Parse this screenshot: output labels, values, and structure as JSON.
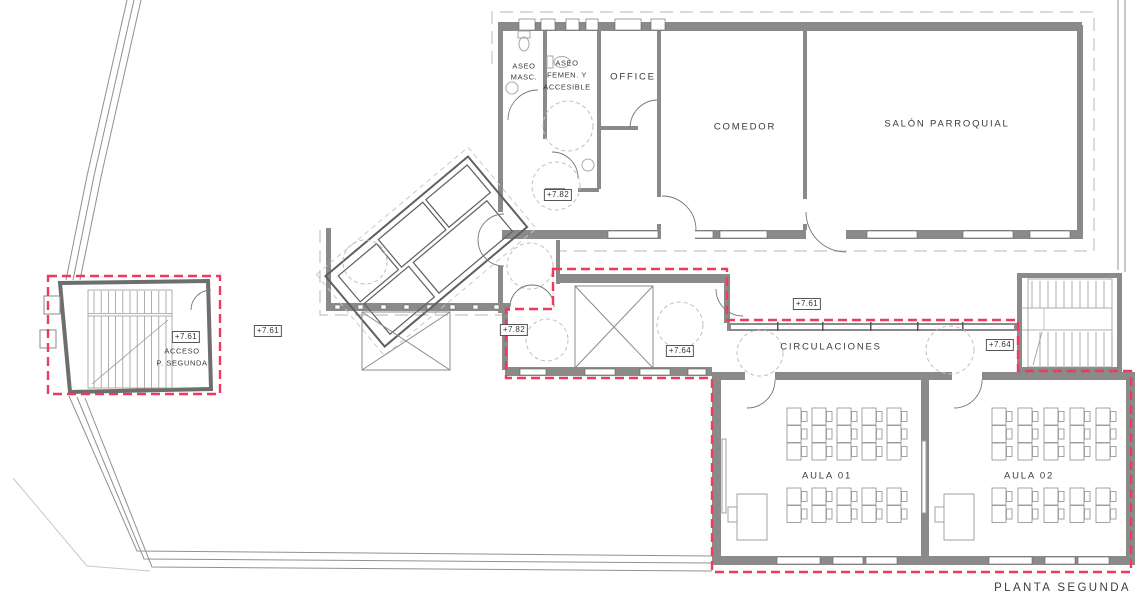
{
  "title": "PLANTA SEGUNDA",
  "rooms": {
    "aseo_masc": {
      "line1": "ASEO",
      "line2": "MASC."
    },
    "aseo_femen": {
      "line1": "ASEO",
      "line2": "FEMEN. Y",
      "line3": "ACCESIBLE"
    },
    "office": {
      "label": "OFFICE"
    },
    "comedor": {
      "label": "COMEDOR"
    },
    "salon": {
      "label": "SALÓN PARROQUIAL"
    },
    "circulaciones": {
      "label": "CIRCULACIONES"
    },
    "aula01": {
      "label": "AULA 01"
    },
    "aula02": {
      "label": "AULA 02"
    },
    "acceso": {
      "line1": "ACCESO",
      "line2": "P. SEGUNDA"
    }
  },
  "levels": {
    "stair_left": "+7.61",
    "terrace": "+7.61",
    "hall": "+7.82",
    "vestibule": "+7.82",
    "patio": "+7.61",
    "corridor_west": "+7.64",
    "corridor_east": "+7.64"
  },
  "colors": {
    "red_dash": "#ee3a5e",
    "wall_fill": "#8a8a8a",
    "line_light": "#c4c4c4",
    "text": "#3a3a3a"
  },
  "furniture": {
    "aula_desks": {
      "cols": 5,
      "rows_front": 3,
      "rows_back": 2
    },
    "stair_left_treads": 11,
    "stair_right_treads": 10
  }
}
